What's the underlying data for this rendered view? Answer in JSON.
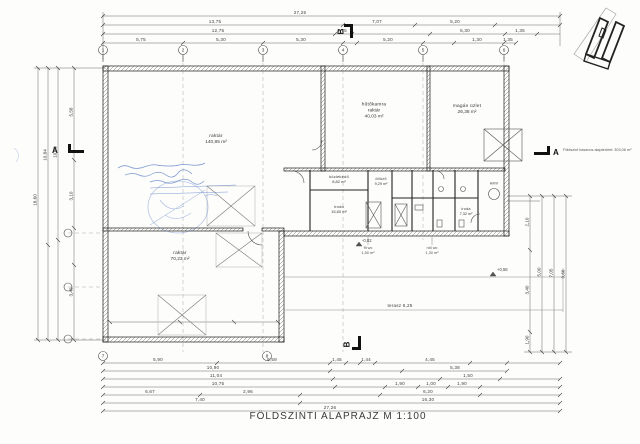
{
  "title": "FÖLDSZINTI ALAPRAJZ  M 1:100",
  "area_note": "Földszint hasznos alapterület: 303,06 m²",
  "grid_top": [
    "1",
    "2",
    "3",
    "4",
    "5",
    "6"
  ],
  "grid_bottom": [
    "7",
    "8"
  ],
  "sections": {
    "a": "A",
    "b": "B"
  },
  "rooms": {
    "hall": {
      "l1": "raktár",
      "l2": "140,85 m²"
    },
    "cold": {
      "l1": "hűtőkamra",
      "l2": "raktár",
      "l3": "40,03 m²"
    },
    "shop": {
      "l1": "magán üzlet",
      "l2": "26,38 m²"
    },
    "store2": {
      "l1": "raktár",
      "l2": "70,23 m²"
    },
    "corridor": {
      "l1": "közlekedő",
      "l2": "8,82 m²"
    },
    "office": {
      "l1": "iroda",
      "l2": "15,60 m²"
    },
    "locker": {
      "l1": "öltöző",
      "l2": "9,29 m²"
    },
    "office2": {
      "l1": "iroda",
      "l2": "7,32 m²"
    },
    "hmv": {
      "l1": "HMV"
    },
    "wc_m": {
      "l1": "ffi wc",
      "l2": "1,50 m²"
    },
    "wc_f": {
      "l1": "női wc",
      "l2": "1,30 m²"
    }
  },
  "dims": {
    "top": [
      "27,25",
      "13,75",
      "7,07",
      "5,20",
      "12,75",
      "1,75",
      "5,30",
      "1,35",
      "5,75",
      "5,30",
      "5,30",
      "5,20",
      "1,30",
      "1,35"
    ],
    "bottom": [
      "5,90",
      "5,59",
      "1,45",
      "1,44",
      "4,45",
      "10,90",
      "5,38",
      "11,04",
      "1,50",
      "10,75",
      "1,90",
      "1,00",
      "1,90",
      "6,67",
      "2,96",
      "6,20",
      "7,40",
      "16,30",
      "27,26"
    ],
    "left": [
      "18,60",
      "10,84",
      "10,03",
      "5,58",
      "3,10",
      "3,40"
    ],
    "right": [
      "2,10",
      "3,40",
      "1,90",
      "5,00",
      "7,05",
      "9,66"
    ]
  },
  "annotations": {
    "terrace": "terasz 6,25",
    "elev1": "+0,58",
    "elev2": "-0,02"
  }
}
